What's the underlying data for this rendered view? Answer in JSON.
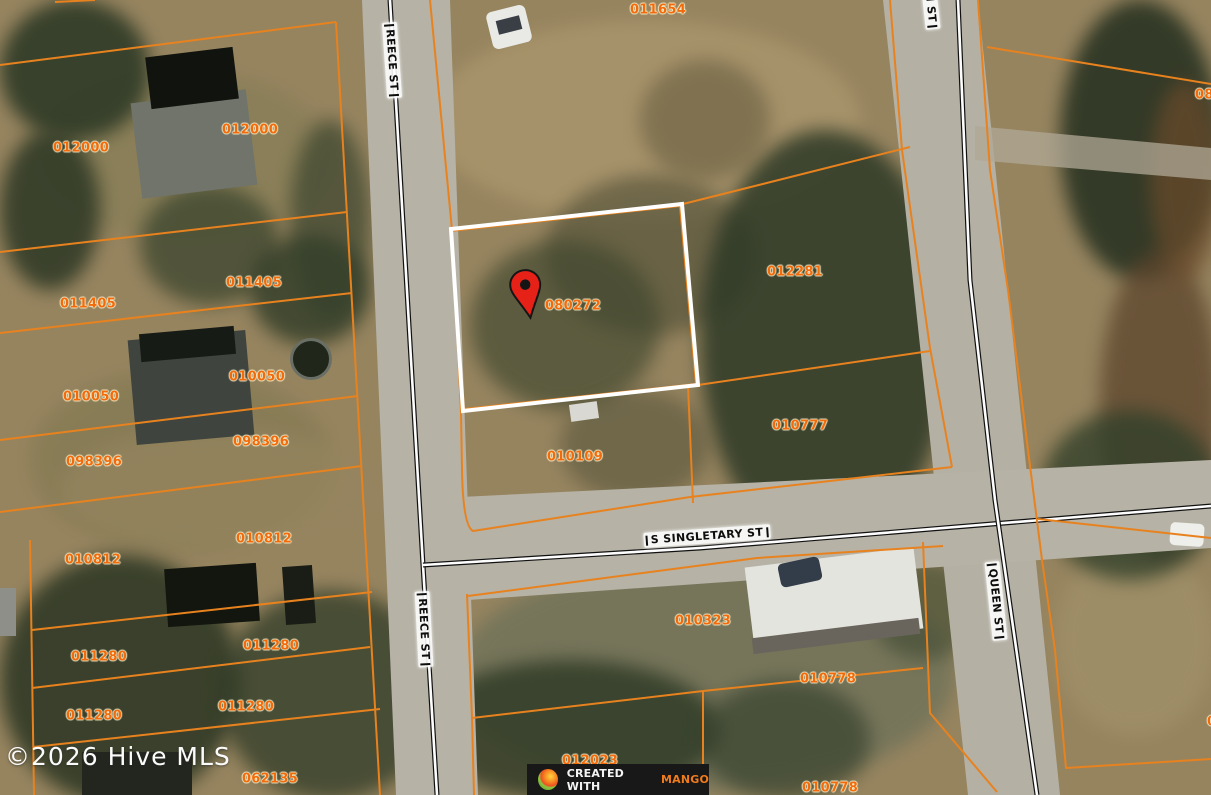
{
  "map": {
    "watermark": "©2026 Hive MLS",
    "badge": {
      "prefix": "CREATED WITH",
      "brand": "MANGO",
      "logo": "mango-icon"
    },
    "subject_parcel_id": "080272",
    "pin": {
      "name": "red-location-pin",
      "color": "#e62117"
    },
    "colors": {
      "parcel_line": "#e8821e",
      "parcel_label_text": "#f26a0a",
      "subject_outline": "#ffffff",
      "road": "#b6b2a6",
      "street_centerline": "#111111"
    },
    "parcel_labels": [
      {
        "text": "012000",
        "x": 81,
        "y": 148
      },
      {
        "text": "011405",
        "x": 88,
        "y": 304
      },
      {
        "text": "010050",
        "x": 91,
        "y": 397
      },
      {
        "text": "098396",
        "x": 94,
        "y": 462
      },
      {
        "text": "010812",
        "x": 93,
        "y": 560
      },
      {
        "text": "011280",
        "x": 99,
        "y": 657
      },
      {
        "text": "011280",
        "x": 94,
        "y": 716
      },
      {
        "text": "012000",
        "x": 250,
        "y": 130
      },
      {
        "text": "011405",
        "x": 254,
        "y": 283
      },
      {
        "text": "010050",
        "x": 257,
        "y": 377
      },
      {
        "text": "098396",
        "x": 261,
        "y": 442
      },
      {
        "text": "010812",
        "x": 264,
        "y": 539
      },
      {
        "text": "011280",
        "x": 271,
        "y": 646
      },
      {
        "text": "011280",
        "x": 246,
        "y": 707
      },
      {
        "text": "062135",
        "x": 270,
        "y": 779
      },
      {
        "text": "011654",
        "x": 658,
        "y": 10
      },
      {
        "text": "012281",
        "x": 795,
        "y": 272
      },
      {
        "text": "080272",
        "x": 573,
        "y": 306
      },
      {
        "text": "010777",
        "x": 800,
        "y": 426
      },
      {
        "text": "010109",
        "x": 575,
        "y": 457
      },
      {
        "text": "010323",
        "x": 703,
        "y": 621
      },
      {
        "text": "010778",
        "x": 828,
        "y": 679
      },
      {
        "text": "012023",
        "x": 590,
        "y": 761
      },
      {
        "text": "010778",
        "x": 830,
        "y": 788
      },
      {
        "text": "080",
        "x": 1195,
        "y": 95
      },
      {
        "text": "010",
        "x": 1207,
        "y": 722
      }
    ],
    "street_labels": [
      {
        "text": "REECE ST",
        "x": 392,
        "y": 60,
        "angle": 86
      },
      {
        "text": "REECE ST",
        "x": 424,
        "y": 629,
        "angle": 87
      },
      {
        "text": "S SINGLETARY ST",
        "x": 707,
        "y": 536,
        "angle": -4
      },
      {
        "text": "QUEEN ST",
        "x": 996,
        "y": 601,
        "angle": 84
      },
      {
        "text": "QUEEN ST",
        "x": 929,
        "y": -10,
        "angle": 84
      }
    ]
  }
}
